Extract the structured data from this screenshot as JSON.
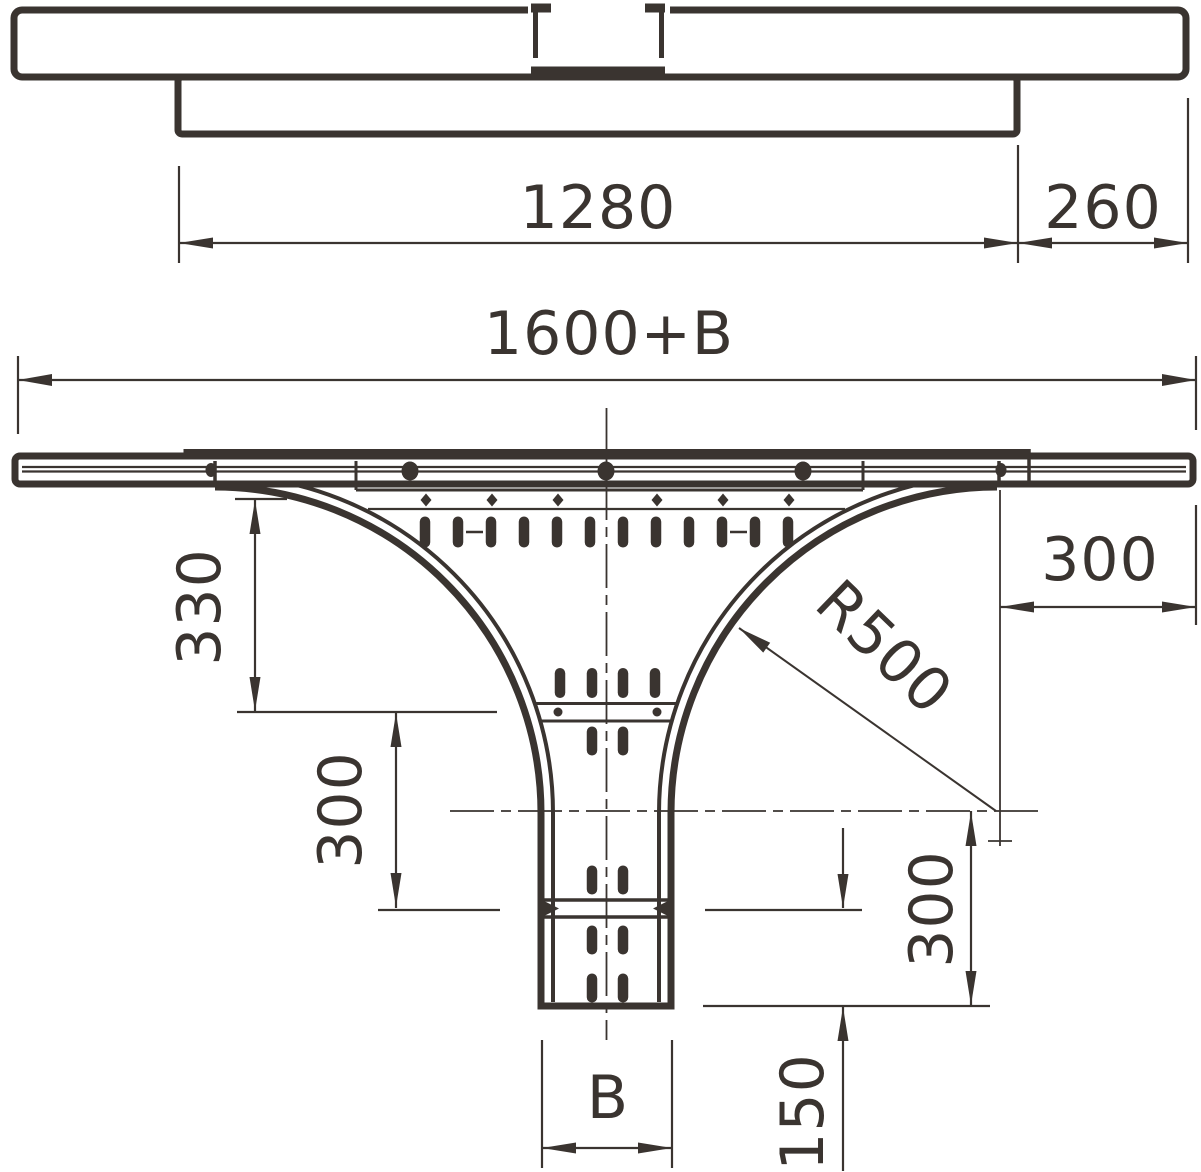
{
  "drawing": {
    "title": "Cable tray add-on tee - dimensional drawing",
    "colors": {
      "line": "#3a3430",
      "background": "#ffffff"
    },
    "labels": {
      "top_length": "1280",
      "top_extension": "260",
      "overall_length": "1600+B",
      "branch_drop": "330",
      "left_spacing": "300",
      "radius": "R500",
      "rail_offset": "300",
      "center_drop": "300",
      "end_segment": "150",
      "branch_width": "B"
    }
  }
}
